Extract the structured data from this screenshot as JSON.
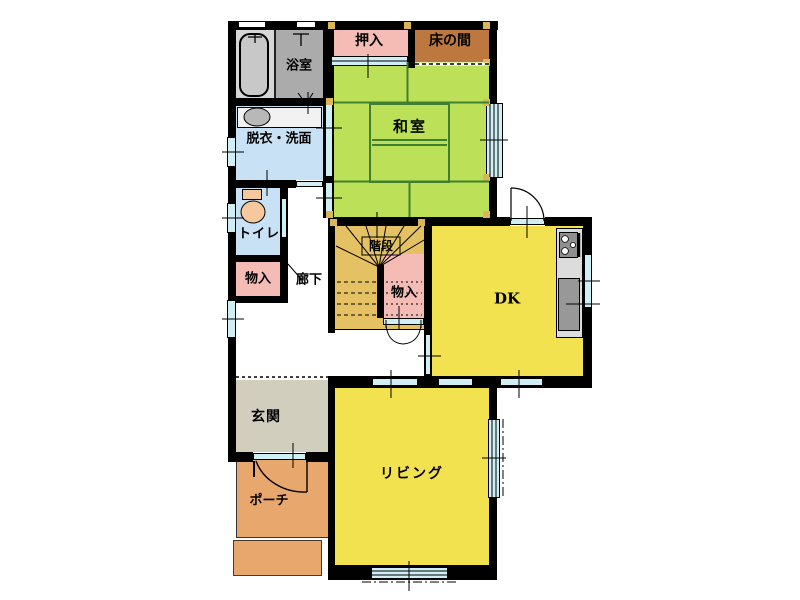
{
  "page": {
    "type": "japanese-house-floor-plan",
    "floor": "1F",
    "background": "#FFFFFF"
  },
  "rooms": {
    "bathroom": {
      "label": "浴室"
    },
    "washroom": {
      "label": "脱衣・洗面"
    },
    "toilet": {
      "label": "トイレ"
    },
    "hall_storage": {
      "label": "物入"
    },
    "hallway": {
      "label": "廊下"
    },
    "oshiire": {
      "label": "押入"
    },
    "tokonoma": {
      "label": "床の間"
    },
    "washitsu": {
      "label": "和室"
    },
    "stairs": {
      "label": "階段"
    },
    "understairs_storage": {
      "label": "物入"
    },
    "dk": {
      "label": "DK"
    },
    "genkan": {
      "label": "玄関"
    },
    "porch": {
      "label": "ポーチ"
    },
    "living": {
      "label": "リビング"
    }
  },
  "colors": {
    "wall": "#000000",
    "tatami_green": "#BDE059",
    "tatami_line": "#3F7F2F",
    "room_yellow": "#F3E24F",
    "stair_tan": "#E4C263",
    "closet_pink": "#F4BCB4",
    "tokonoma_brown": "#BD7840",
    "wet_room_blue": "#C9E1F4",
    "window_cyan": "#CFEFF4",
    "genkan_beige": "#D2CEBE",
    "porch_orange": "#E8A76C",
    "bath_tub_area": "#D6D6D6",
    "bath_shower_area": "#ABABAB",
    "fixture_gray": "#989898",
    "toilet_peach": "#F6C89E",
    "pillar_tan": "#D9B657"
  }
}
